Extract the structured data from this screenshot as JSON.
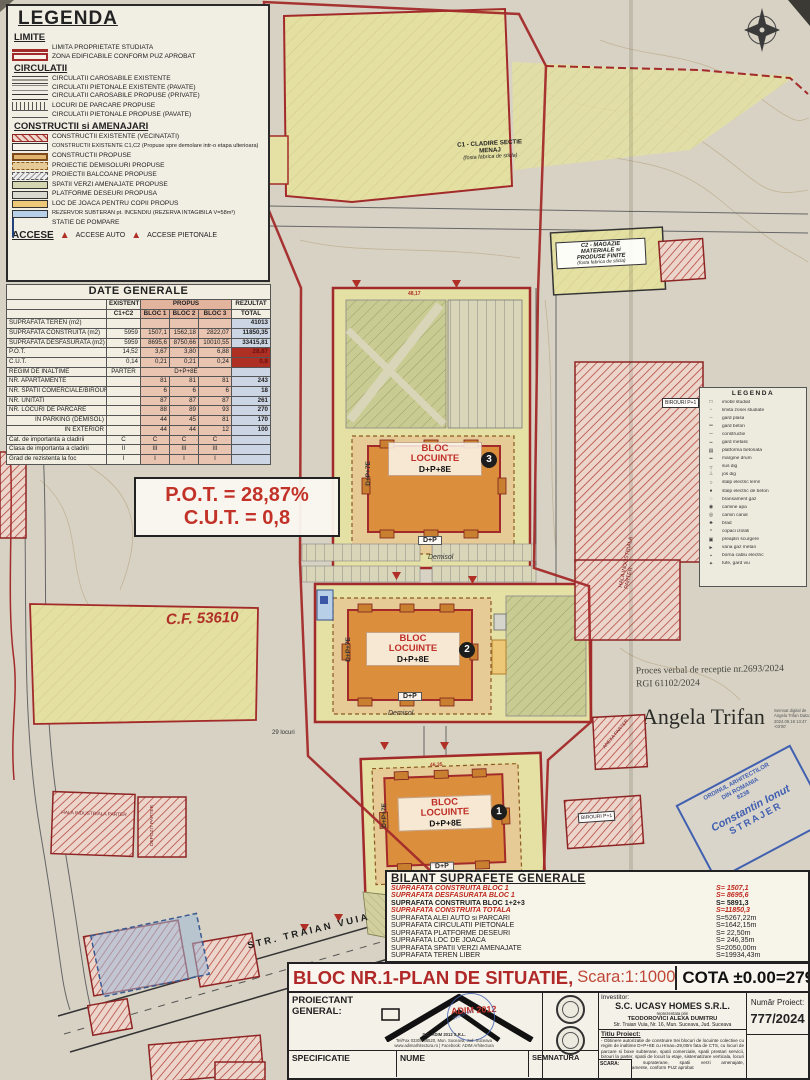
{
  "legend": {
    "title": "LEGENDA",
    "s_limite": "LIMITE",
    "s_circulatii": "CIRCULATII",
    "s_constructii": "CONSTRUCTII si AMENAJARI",
    "items": {
      "limita": "LIMITA PROPRIETATE STUDIATA",
      "zona": "ZONA EDIFICABILE CONFORM PUZ APROBAT",
      "caros_ex": "CIRCULATII CAROSABILE EXISTENTE",
      "piet_ex": "CIRCULATII PIETONALE EXISTENTE (PAVATE)",
      "caros_prop": "CIRCULATII CAROSABILE PROPUSE (PRIVATE)",
      "parcare": "LOCURI DE PARCARE PROPUSE",
      "piet_prop": "CIRCULATII PIETONALE PROPUSE (PAVATE)",
      "constr_ex": "CONSTRUCTII EXISTENTE (VECINATATI)",
      "constr_c1c2": "CONSTRUCTII EXISTENTE C1,C2 (Propuse spre demolare intr-o etapa ulterioara)",
      "constr_prop": "CONSTRUCTII PROPUSE",
      "demisol": "PROIECTIE DEMISOLURI PROPUSE",
      "balcoane": "PROIECTII BALCOANE PROPUSE",
      "verzi": "SPATII VERZI AMENAJATE PROPUSE",
      "platforme": "PLATFORME DESEURI PROPUSA",
      "joaca": "LOC DE JOACA PENTRU COPII PROPUS",
      "rezervor": "REZERVOR SUBTERAN pt. INCENDIU (REZERVA INTAGIBILA V=58m³)",
      "pompare": "STATIE DE POMPARE"
    },
    "accese": "ACCESE",
    "accese_auto": "ACCESE AUTO",
    "accese_piet": "ACCESE PIETONALE"
  },
  "date_generale": {
    "title": "DATE GENERALE",
    "h_existent": "EXISTENT",
    "h_propus": "PROPUS",
    "h_rezultat": "REZULTAT",
    "h_c1c2": "C1+C2",
    "h_b1": "BLOC 1",
    "h_b2": "BLOC 2",
    "h_b3": "BLOC 3",
    "h_total": "TOTAL",
    "rows": [
      [
        "SUPRAFATA TEREN (m2)",
        "",
        "",
        "",
        "",
        "41013"
      ],
      [
        "SUPRAFATA CONSTRUITA (m2)",
        "5959",
        "1507,1",
        "1562,18",
        "2822,07",
        "11850,35"
      ],
      [
        "SUPRAFATA DESFASURATA (m2)",
        "5959",
        "8695,6",
        "8750,66",
        "10010,55",
        "33415,81"
      ],
      [
        "P.O.T.",
        "14,52",
        "3,67",
        "3,80",
        "6,88",
        "28,87"
      ],
      [
        "C.U.T.",
        "0,14",
        "0,21",
        "0,21",
        "0,24",
        "0,8"
      ],
      [
        "REGIM DE INALTIME",
        "PARTER",
        "D+P+8E",
        "",
        "",
        ""
      ],
      [
        "NR. APARTAMENTE",
        "",
        "81",
        "81",
        "81",
        "243"
      ],
      [
        "NR. SPATII COMERCIALE/BIROURI",
        "",
        "6",
        "6",
        "6",
        "18"
      ],
      [
        "NR. UNITATI",
        "",
        "87",
        "87",
        "87",
        "261"
      ],
      [
        "NR. LOCURI DE PARCARE",
        "",
        "88",
        "89",
        "93",
        "270"
      ],
      [
        "IN PARKING (DEMISOL)",
        "",
        "44",
        "45",
        "81",
        "170"
      ],
      [
        "IN EXTERIOR",
        "",
        "44",
        "44",
        "12",
        "100"
      ],
      [
        "Cat. de importanta a cladirii",
        "C",
        "C",
        "C",
        "C",
        ""
      ],
      [
        "Clasa de importanta a cladirii",
        "II",
        "III",
        "III",
        "III",
        ""
      ],
      [
        "Grad de rezistenta la foc",
        "I",
        "I",
        "I",
        "I",
        ""
      ]
    ]
  },
  "indicators": {
    "pot": "P.O.T. = 28,87%",
    "cut": "C.U.T. = 0,8"
  },
  "map": {
    "c1_l1": "C1 - CLADIRE SECTIE",
    "c1_l2": "MENAJ",
    "c1_l3": "(fosta fabrica de sticla)",
    "c2_l1": "C2 - MAGAZIE",
    "c2_l2": "MATERIALE si",
    "c2_l3": "PRODUSE FINITE",
    "c2_l4": "(fosta fabrica de sticla)",
    "anexa": "ANEXA PARTER",
    "hala": "HALA INDUSTRIALA PARTER",
    "depozit": "DEPOZIT PARTER",
    "birouri": "BIROURI P+1",
    "cf": "C.F. 53610",
    "street": "STR. TRAIAN VUIA",
    "locuri": "29 locuri",
    "dim1": "48,17",
    "dim2": "46,35",
    "block": {
      "name1": "BLOC",
      "name2": "LOCUINTE",
      "regim": "D+P+8E",
      "side": "D+P+7E",
      "dp": "D+P",
      "demisol": "Demisol"
    },
    "badges": [
      "3",
      "2",
      "1"
    ],
    "proces_l1": "Proces verbal de receptie nr.2693/2024",
    "proces_l2": "RGI 61102/2024",
    "sign_name": "Angela Trifan",
    "sign_meta": "Semnat digital de Angela Trifan Data: 2024.09.18 13:47 -03'00'",
    "stamp": {
      "l1": "ORDINUL ARHITECTILOR",
      "l2": "DIN ROMANIA",
      "l3": "8238",
      "n1": "Constantin Ionut",
      "n2": "STRAJER"
    },
    "mini": {
      "title": "LEGENDA",
      "items": [
        {
          "g": "□",
          "label": "imobil studiat"
        },
        {
          "g": "▫",
          "label": "limita zonei studiate"
        },
        {
          "g": "┄",
          "label": "gard plasa"
        },
        {
          "g": "═",
          "label": "gard beton"
        },
        {
          "g": "─",
          "label": "constructie"
        },
        {
          "g": "┅",
          "label": "gard metalic"
        },
        {
          "g": "▤",
          "label": "platforma betonata"
        },
        {
          "g": "━",
          "label": "margine drum"
        },
        {
          "g": "┬",
          "label": "sus dig"
        },
        {
          "g": "┴",
          "label": "jos dig"
        },
        {
          "g": "○",
          "label": "stalp electric lemn"
        },
        {
          "g": "●",
          "label": "stalp electric de beton"
        },
        {
          "g": "◌",
          "label": "bransament gaz"
        },
        {
          "g": "◉",
          "label": "camine apa"
        },
        {
          "g": "◎",
          "label": "camin canal"
        },
        {
          "g": "♣",
          "label": "brad"
        },
        {
          "g": "*",
          "label": "copaci izolati"
        },
        {
          "g": "▣",
          "label": "preaplin scurgere"
        },
        {
          "g": "►",
          "label": "vana gaz metan"
        },
        {
          "g": "▪",
          "label": "borna cablu electric"
        },
        {
          "g": "✦",
          "label": "tufe, gard viu"
        }
      ]
    }
  },
  "bilant": {
    "title": "BILANT SUPRAFETE GENERALE",
    "rows": [
      {
        "label": "SUPRAFATA CONSTRUITA BLOC 1",
        "value": "S= 1507,1"
      },
      {
        "label": "SUPRAFATA DESFASURATA BLOC 1",
        "value": "S= 8695,6"
      },
      {
        "label": "SUPRAFATA CONSTRUITA BLOC 1+2+3",
        "value": "S= 5891,3"
      },
      {
        "label": "SUPRAFATA CONSTRUITA TOTALA",
        "value": "S=11850,3"
      },
      {
        "label": "SUPRAFATA ALEI AUTO si PARCARI",
        "value": "S=5267,22m"
      },
      {
        "label": "SUPRAFATA CIRCULATII PIETONALE",
        "value": "S=1642,15m"
      },
      {
        "label": "SUPRAFATA PLATFORME DESEURI",
        "value": "S=  22,50m"
      },
      {
        "label": "SUPRAFATA LOC DE JOACA",
        "value": "S= 246,35m"
      },
      {
        "label": "SUPRAFATA SPATII VERZI AMENAJATE",
        "value": "S=2050,00m"
      },
      {
        "label": "SUPRAFATA TEREN LIBER",
        "value": "S=19934,43m"
      }
    ]
  },
  "titlebar": {
    "title": "BLOC NR.1-PLAN DE SITUATIE,",
    "scale": "Scara:1:1000",
    "cota": "COTA ±0.00=279,50"
  },
  "titleblock": {
    "proiectant": "PROIECTANT GENERAL:",
    "firm_l1": "S.C. ADIM 2012 S.R.L.",
    "firm_l2": "Tel/Fax 0330/566520, Mun. Suceava, Jud. Suceava",
    "firm_l3": "www.adimarhitectura.ro | Facebook: ADIM Arhitectura",
    "adim_logo_text": "ADIM 2012",
    "adim_stamp_no": "33983/2011",
    "investitor_label": "Investitor:",
    "investitor": "S.C. UCASY HOMES S.R.L.",
    "rep": "reprezentata prin",
    "rep_name": "TEODOROVICI ALEXA DUMITRU",
    "addr": "Str. Traian Vuia, Nr. 16, Mun. Suceava, Jud. Suceava",
    "titlu_label": "Titlu Proiect:",
    "titlu_text": "- Obtinere autorizatie de construire trei blocuri de locuinte colective cu regim de inaltime D+P+8E cu Hmax=29,00m fata de CTS, cu locuri de parcare si boxe subterane, spatii comerciale, spatii prestari servicii, birouri la parter, spatii de locuit la etaje, sistematizare verticala, locuri de parcare supraterane, spatii verzi amenajate, racorduri/bransamente, conform PUZ aprobat",
    "numar_label": "Număr Proiect:",
    "numar": "777/2024",
    "spec": "SPECIFICATIE",
    "nume": "NUME",
    "semnatura": "SEMNATURA",
    "scara": "SCARA:"
  }
}
